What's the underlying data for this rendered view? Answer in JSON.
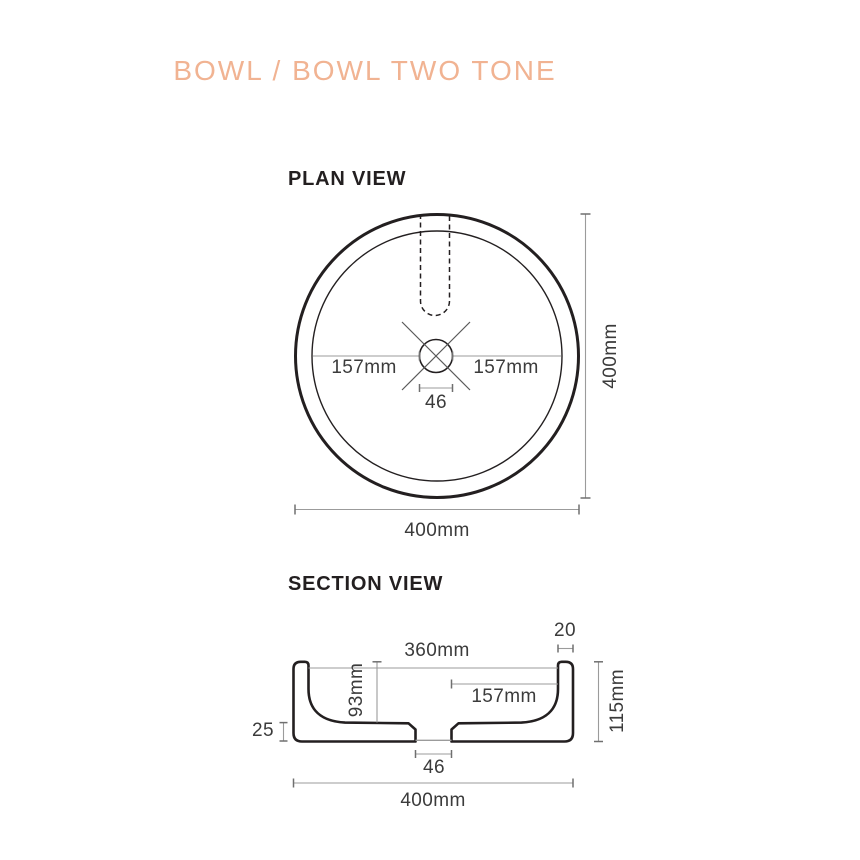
{
  "colors": {
    "background": "#ffffff",
    "accent_title": "#f1b392",
    "drawing_line": "#231f20",
    "dimension_line": "#9b9b9b",
    "dimension_text": "#3b3b3b"
  },
  "title": "BOWL / BOWL TWO TONE",
  "plan_view": {
    "heading": "PLAN VIEW",
    "dimensions": {
      "left_to_drain": "157mm",
      "drain_to_right": "157mm",
      "drain_diameter": "46",
      "overall_height": "400mm",
      "overall_width": "400mm"
    }
  },
  "section_view": {
    "heading": "SECTION VIEW",
    "dimensions": {
      "rim_thickness": "20",
      "inner_width": "360mm",
      "inner_depth": "93mm",
      "drain_to_wall": "157mm",
      "overall_height": "115mm",
      "base_thickness": "25",
      "drain_width": "46",
      "overall_width": "400mm"
    }
  }
}
